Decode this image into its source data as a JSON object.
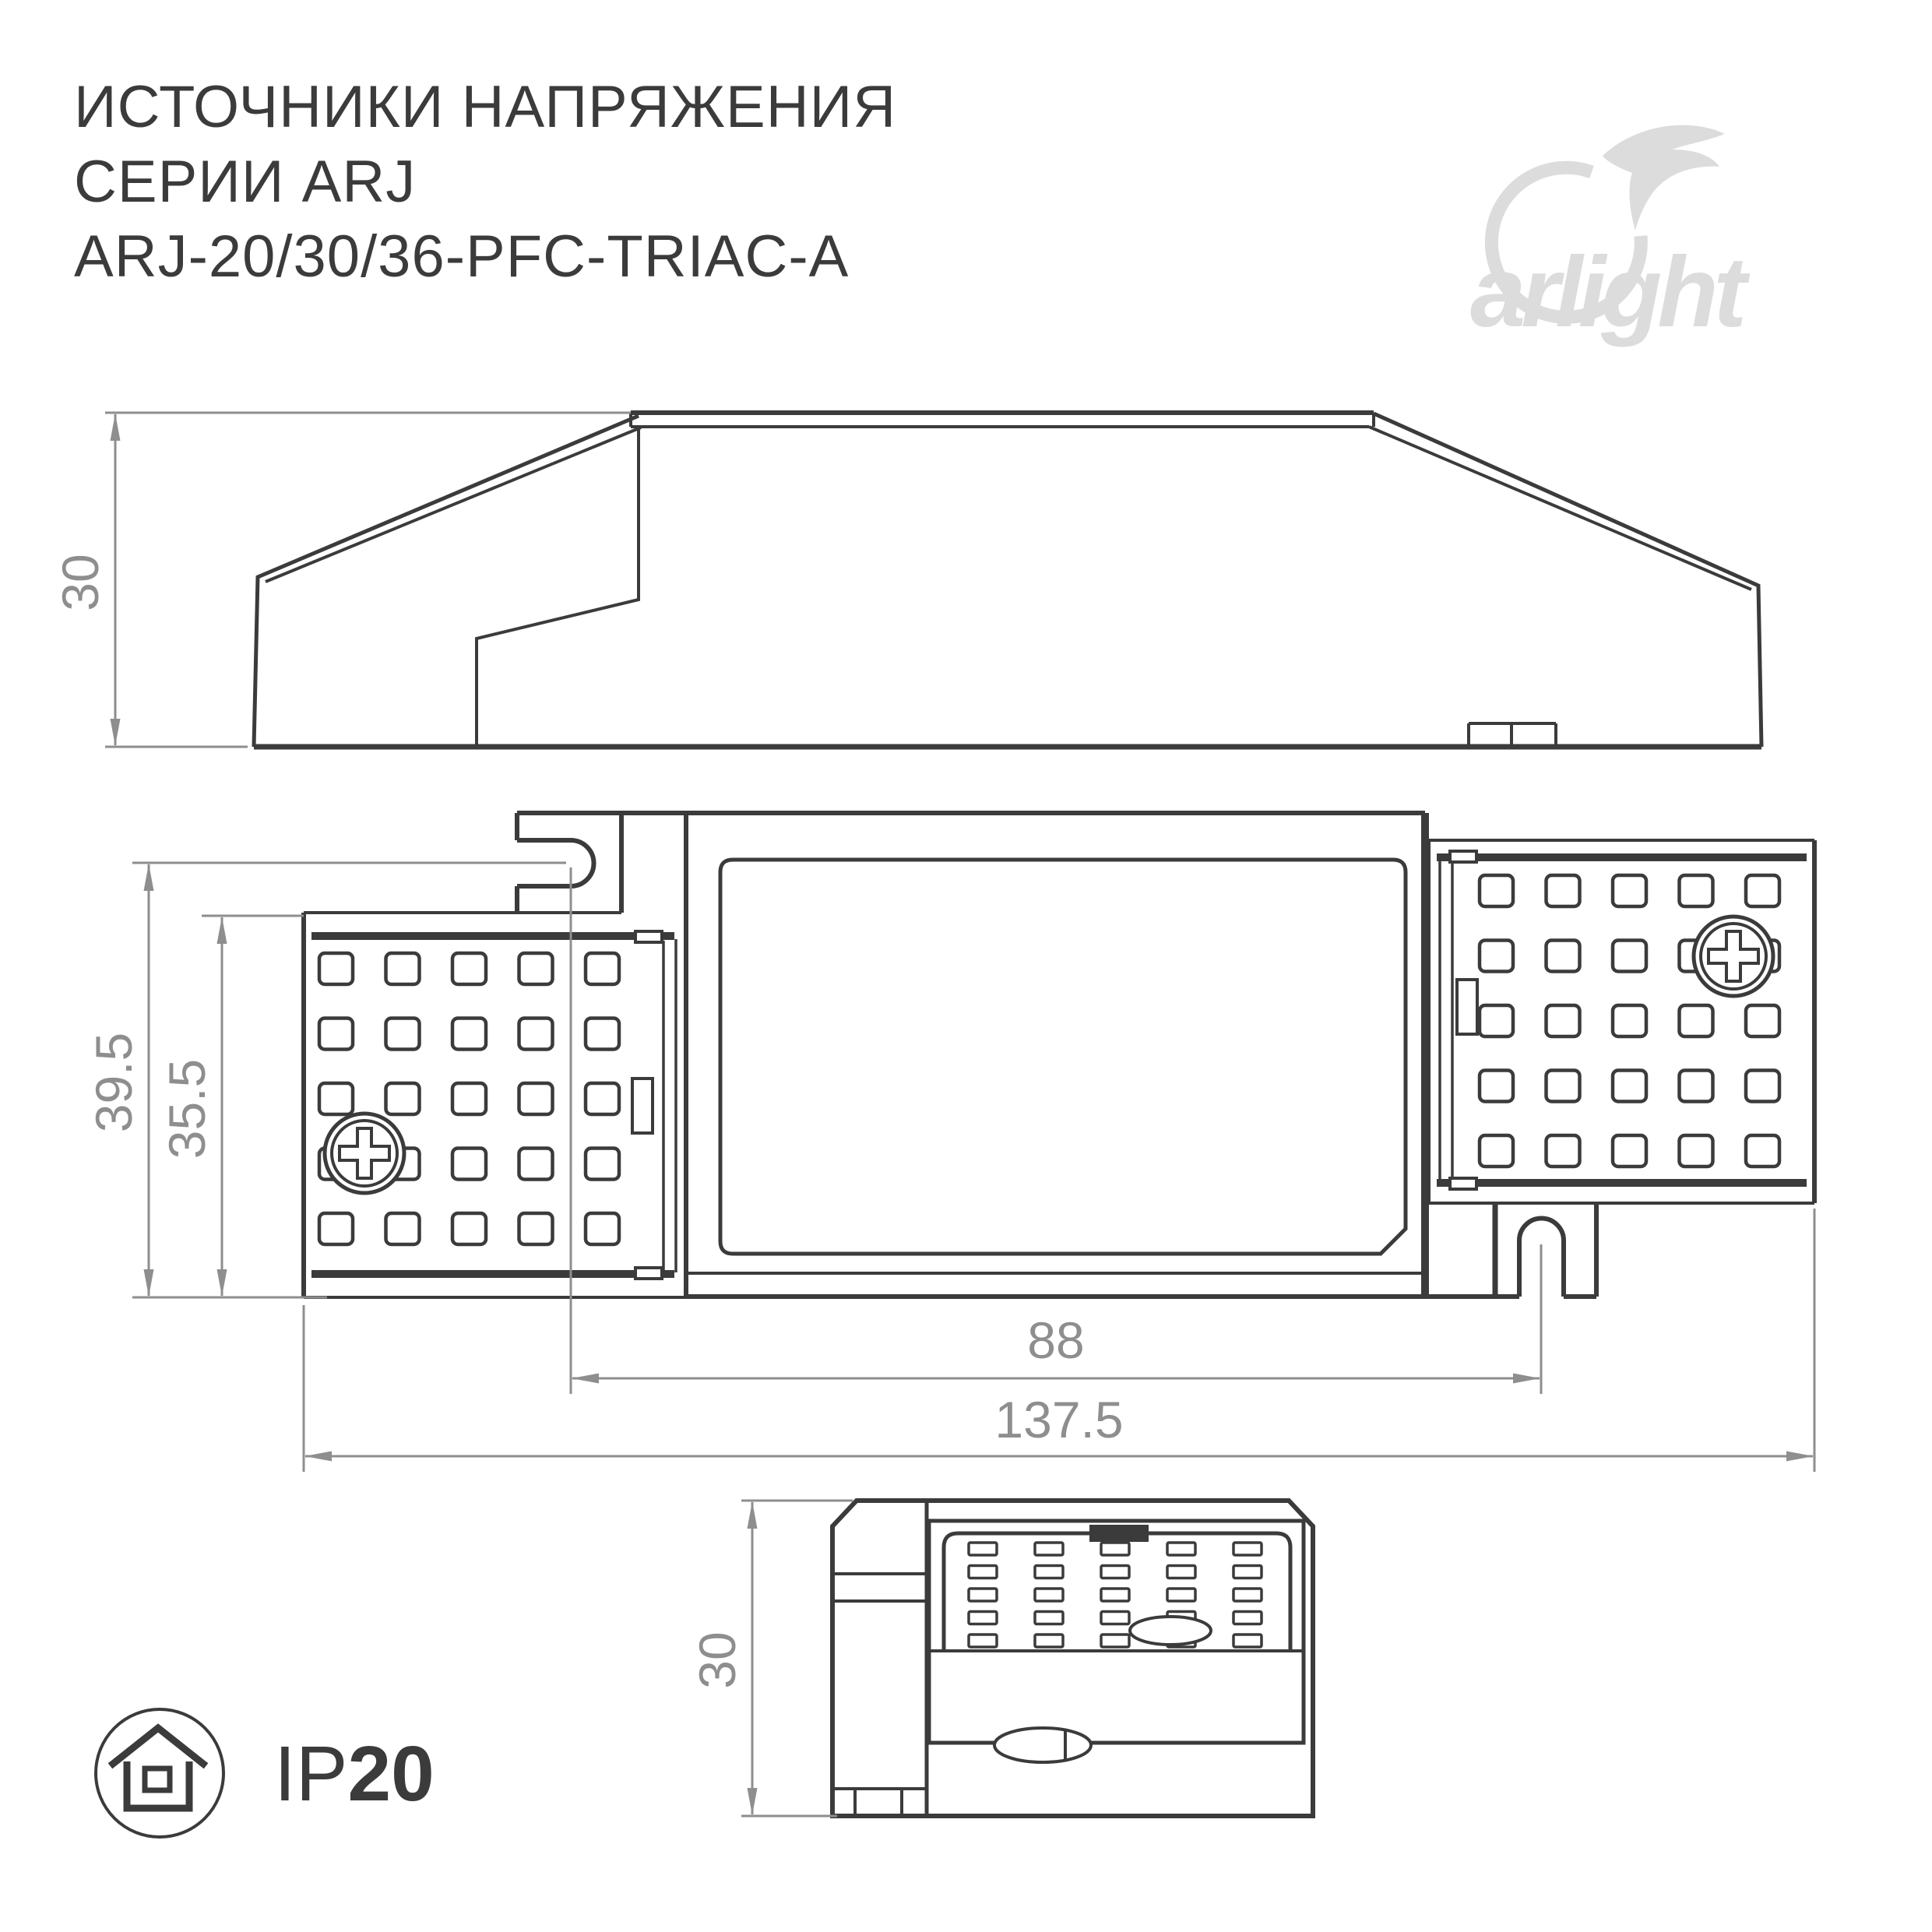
{
  "title": {
    "line1": "ИСТОЧНИКИ НАПРЯЖЕНИЯ",
    "line2": "СЕРИИ ARJ",
    "line3": "ARJ-20/30/36-PFC-TRIAC-A"
  },
  "logo": {
    "brand": "arlight"
  },
  "colors": {
    "ink": "#3b3b3b",
    "dim": "#8e8e8e",
    "logo": "#dcdcdc",
    "background": "#ffffff"
  },
  "icons": {
    "swoosh": "arlight-swoosh-icon",
    "house": "house-icon",
    "screw": "phillips-screw-icon"
  },
  "views": {
    "side": {
      "label": "side-view",
      "height_dim": "30"
    },
    "front": {
      "label": "front-view",
      "dims": {
        "mount_height": "39.5",
        "body_height": "35.5",
        "slot_spacing": "88",
        "overall_width": "137.5"
      }
    },
    "end": {
      "label": "end-view",
      "height_dim": "30"
    }
  },
  "badge": {
    "ip_prefix": "IP",
    "ip_value": "20"
  }
}
